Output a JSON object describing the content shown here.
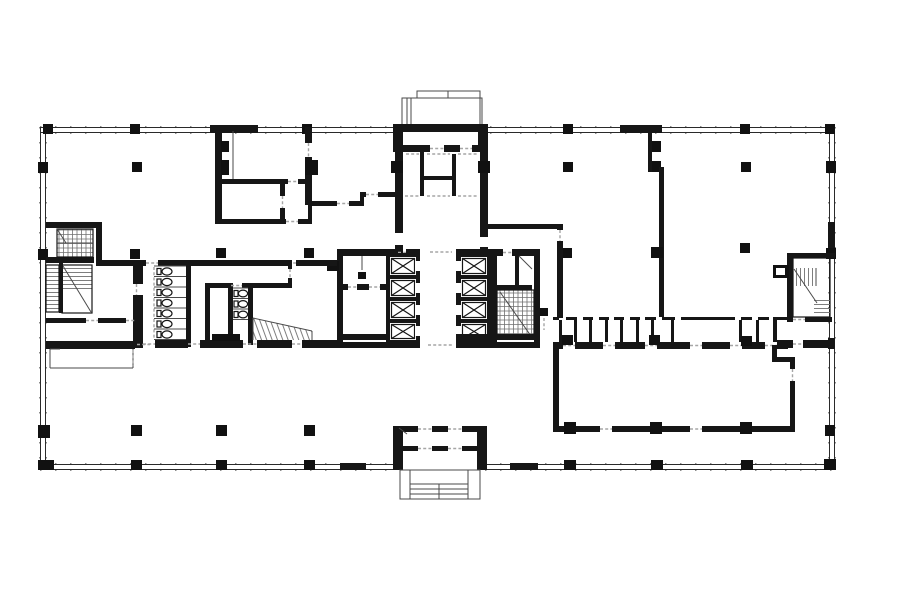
{
  "meta": {
    "title": "Office building floor plan",
    "description": "Black-and-white architectural floor plan: rectangular curtain-wall envelope on a column grid, two central elevator cores with four shafts each, four stair shafts, toilet-stall groups, service corridor with small rooms, and entrance vestibules with canopies at top and bottom center.",
    "canvas": {
      "width": 900,
      "height": 604
    },
    "colors": {
      "background": "#ffffff",
      "wall": "#161616",
      "column": "#111111",
      "thin_line": "#4a4a4a",
      "hatch": "#6f6f6f",
      "door_dash": "#a6a6a6"
    }
  },
  "plan": {
    "features": {
      "elevator_shafts": 8,
      "toilet_stalls_left_group": 7,
      "toilet_stalls_right_group": 3,
      "staircases": 5,
      "entrance_canopies": 2,
      "free_standing_columns": 11,
      "perimeter": "double-line curtain wall with mullion ticks and grid columns"
    }
  }
}
